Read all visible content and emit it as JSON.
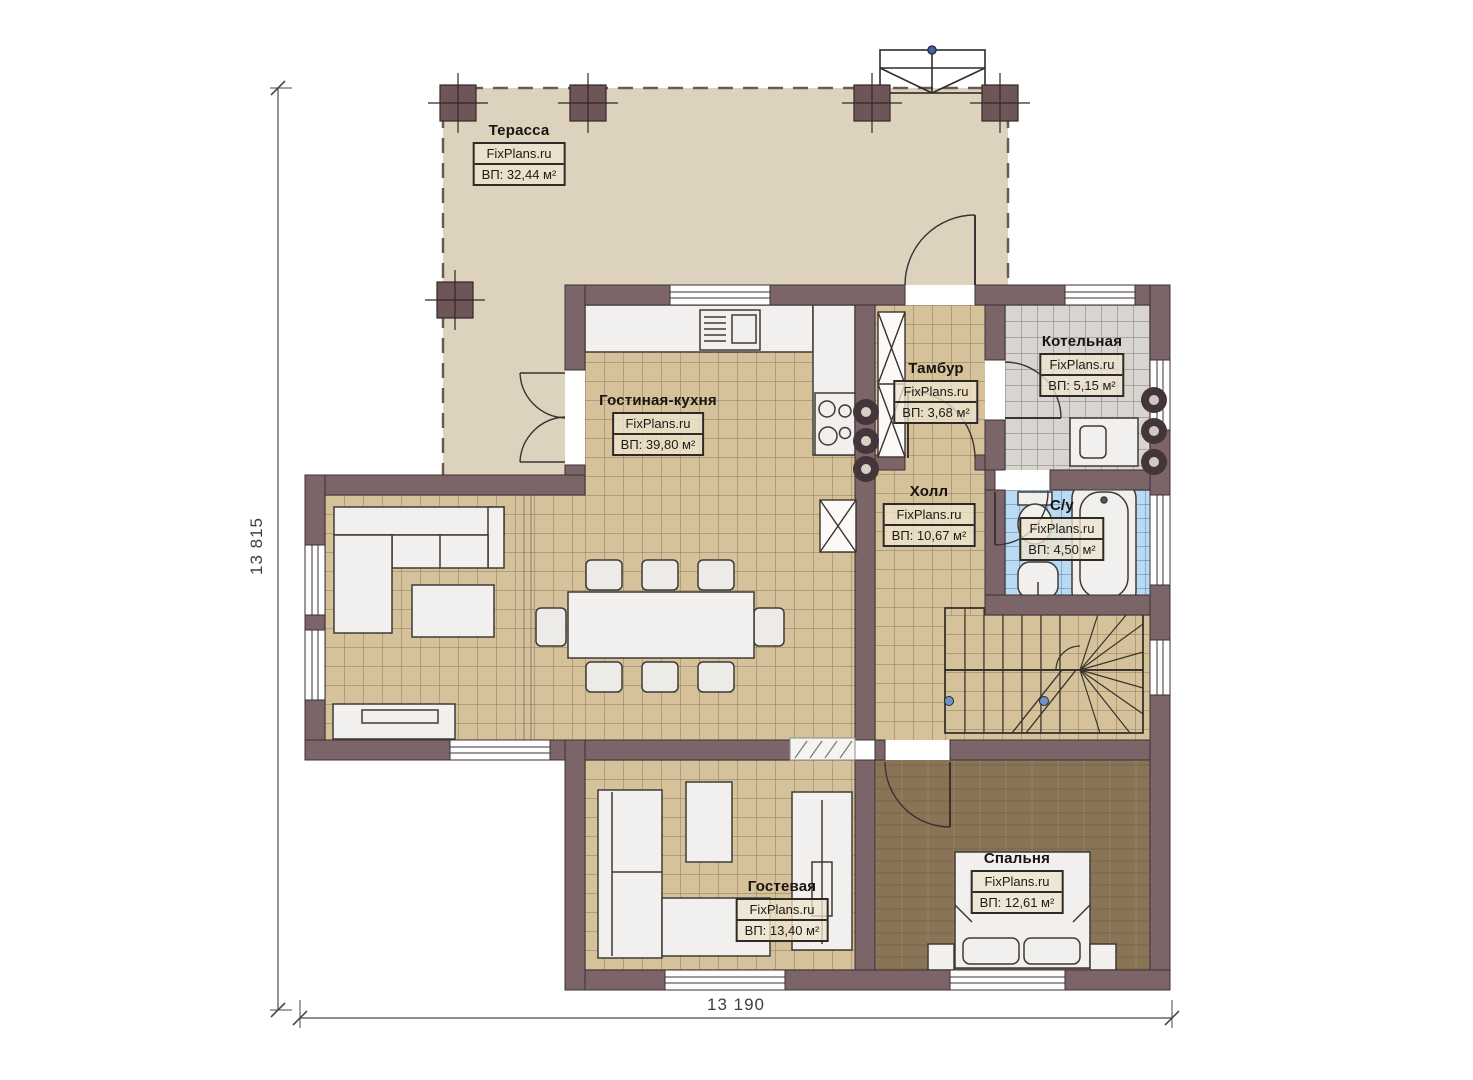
{
  "plan": {
    "brand": "FixPlans.ru",
    "rooms": [
      {
        "id": "terrace",
        "name": "Терасса",
        "watermark": "FixPlans.ru",
        "area": "ВП: 32,44 м²"
      },
      {
        "id": "living_kitchen",
        "name": "Гостиная-кухня",
        "watermark": "FixPlans.ru",
        "area": "ВП: 39,80 м²"
      },
      {
        "id": "tambour",
        "name": "Тамбур",
        "watermark": "FixPlans.ru",
        "area": "ВП: 3,68 м²"
      },
      {
        "id": "boiler",
        "name": "Котельная",
        "watermark": "FixPlans.ru",
        "area": "ВП: 5,15 м²"
      },
      {
        "id": "hall",
        "name": "Холл",
        "watermark": "FixPlans.ru",
        "area": "ВП: 10,67 м²"
      },
      {
        "id": "bathroom",
        "name": "С/у",
        "watermark": "FixPlans.ru",
        "area": "ВП: 4,50 м²"
      },
      {
        "id": "guest",
        "name": "Гостевая",
        "watermark": "FixPlans.ru",
        "area": "ВП: 13,40 м²"
      },
      {
        "id": "bedroom",
        "name": "Спальня",
        "watermark": "FixPlans.ru",
        "area": "ВП: 12,61 м²"
      }
    ],
    "dimensions": {
      "left": "13 815",
      "bottom": "13 190"
    },
    "colors": {
      "wall": "#7b6568",
      "column": "#6e5658",
      "terrace_floor": "#ddd2bd",
      "tile_floor": "#d5c29b",
      "boiler_floor": "#d8d4d0",
      "bath_floor": "#b9daf2",
      "bedroom_floor": "#8a7456",
      "furniture": "#f1f0ee",
      "outline": "#3c3134"
    }
  }
}
